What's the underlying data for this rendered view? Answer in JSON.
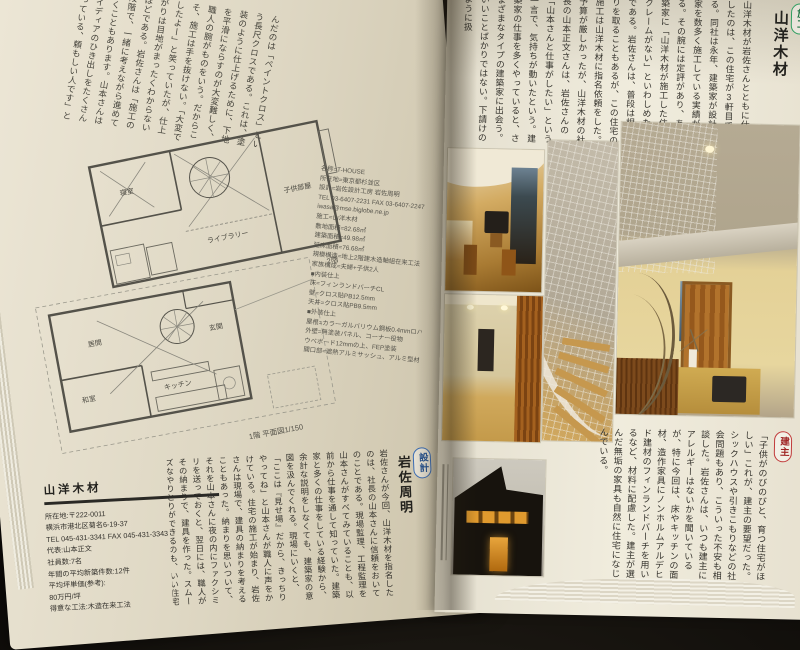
{
  "colors": {
    "background": "#17140f",
    "page_left": "#ded7c3",
    "page_right": "#f0ecdd",
    "label_builder_green": "#2f9e60",
    "label_designer_blue": "#3a6cb4",
    "label_client_red": "#c13b3b",
    "photo_amber": "#c49a4a",
    "plan_line": "#5a5850"
  },
  "left_page": {
    "top_paragraph": "んだのは「ペイントクロス」という長尺クロスである。これは、塗装のように仕上げるために、下地を平滑にならすのが大変難しく、職人の腕がものをいう。だからこそ、施工は手を抜けない。「大変でしたよー」と笑っていたが、仕上がりは目地がまったくわからないほどである。岩佐さんは「施工の段階で、一緒に考えながら進めていくこともあります。山本さんはアイディアのひき出しをたくさん持っている、頼もしい人です」と語る。",
    "plans": {
      "floor2": {
        "rooms": {
          "bedroom": "寝室",
          "kids": "子供部屋",
          "library": "ライブラリー"
        },
        "caption": "2階"
      },
      "floor1": {
        "rooms": {
          "living": "居間",
          "entrance": "玄関",
          "tatami": "和室",
          "kitchen": "キッチン"
        },
        "caption": "1階  平面図1/150"
      }
    },
    "specs": {
      "lines": [
        "名称=T-HOUSE",
        "所在地=東京都杉並区",
        "設計=岩佐設計工房  岩佐周明",
        "TEL 03-6407-2231  FAX 03-6407-2247",
        "iwasa@mse.biglobe.ne.jp",
        "施工=山洋木材",
        "敷地面積=82.68㎡",
        "建築面積=49.98㎡",
        "延床面積=76.68㎡",
        "規模構造=地上2階建木造軸組在来工法",
        "家族構成=夫婦+子供2人",
        "■内装仕上",
        "床=フィンランドバーチCL",
        "壁=クロス貼PB12.5mm",
        "天井=クロス貼PB9.5mm",
        "■外装仕上",
        "屋根=カラーガルバリウム鋼板0.4mmロハゼ葺",
        "外壁=無塗装パネル、コーナー役物",
        "ウベボード12mmの上、FEP塗装",
        "開口部=遮熱アルミサッシュ、アルミ型材"
      ]
    },
    "designer": {
      "tag": "設計",
      "name": "岩佐周明",
      "paragraph": "岩佐さんが今回、山洋木材を指名したのは、社長の山本さんに信頼をおいてのことである。現場監理、工程監理を山本さんがすべてみていることも、以前から仕事を通して知っていた。建築家と多くの仕事をしている経験から、余計な説明をしなくても、建築家の意図を汲んでくれる。現場にいくと、「ここは『見せ場』だから、きっちりやってね」と山本さんが職人に声をかけている。住宅の施工が始まり、岩佐さんは現場で、建具の納まりを考えることもあった。納まりを思いついて、それを山本さんに夜の内にファクシミリを送っておくと、翌日には、職人がその納まりで、建具を作った。スムーズなやりとりができるのも、いい住宅を作る上で重要な過程のひとつである。"
    },
    "company": {
      "name": "山洋木材",
      "lines": [
        "所在地:〒222-0011",
        "横浜市港北区菊名6-19-37",
        "TEL 045-431-3341  FAX 045-431-3343",
        "代表:山本正文",
        "社員数:7名",
        "年間の平均新築件数:12件",
        "平均坪単価(参考):",
        "80万円/坪",
        "得意な工法:木造在来工法"
      ]
    }
  },
  "right_page": {
    "builder": {
      "tag": "施工",
      "name": "山洋木材",
      "paragraph": "山洋木材が岩佐さんとともに仕事をしたのは、この住宅が3軒目である。同社は永年、建築家が設計した家を数多く施工している実績がある。その腕には定評があり、ある建築家に「山洋木材が施工した住宅はクレームがない」といわしめたほどである。岩佐さんは、普段は相見積りを取ることもあるが、この住宅の施工は山洋木材に指名依頼をした。予算が厳しかったが、山洋木材の社長の山本正文さんは、岩佐さんの「山本さんと仕事がしたい」という一言で、気持ちが動いたという。建築家の仕事を多くやっていると、さまざまなタイプの建築家に出会う。いいことばかりではない。下請けのように扱",
      "paragraph_continued": "う人、施工図を工務店まかせにして、一緒に考えない人もいるという。気持ちよく仕事をするためには、建主、山本さんや職人と顔を合わせ、家ができていく様子を語り合いたいという。"
    },
    "client": {
      "tag": "建主",
      "paragraph": "「子供がのびのびと、育つ住宅がほしい」これが、建主の要望だった。シックハウスや引きこもりなどの社会問題もあり、こういった不安も相談した。岩佐さんは、いつも建主にアレルギーはないかを聞いているが、特に今回は、床やキッチンの面材、造作家具にノンホルムアルデヒド建材のフィンランドバーチを用いるなど、材料に配慮した。建主が選んだ無垢の家具も自然に住宅になじんでいる。"
    }
  }
}
